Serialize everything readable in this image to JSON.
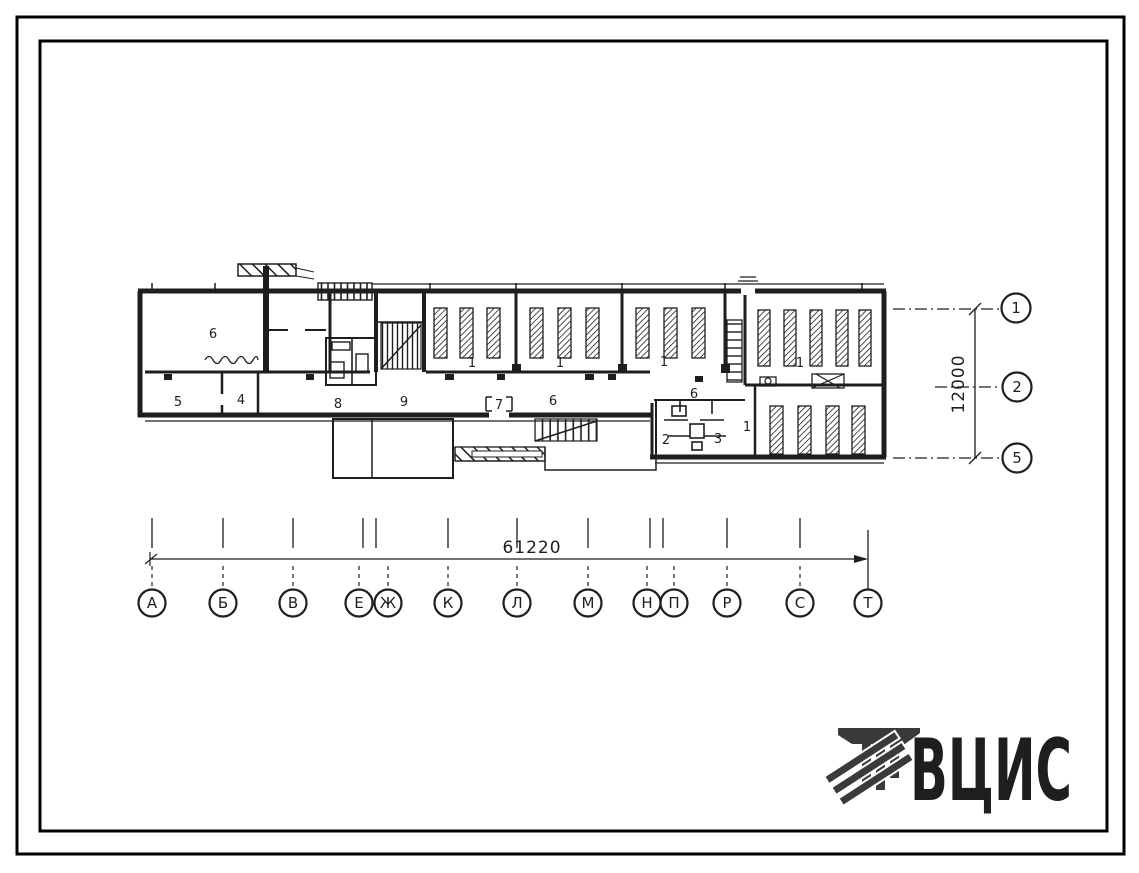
{
  "page": {
    "background": "#ffffff",
    "frame_color": "#000000",
    "ink_color": "#1e1e1e"
  },
  "plan": {
    "room_labels": [
      "6",
      "5",
      "4",
      "8",
      "9",
      "7",
      "6",
      "6",
      "2",
      "3",
      "1",
      "1",
      "1",
      "1",
      "1"
    ]
  },
  "axes": {
    "bottom": {
      "letters": [
        "А",
        "Б",
        "В",
        "Е",
        "Ж",
        "К",
        "Л",
        "М",
        "Н",
        "П",
        "Р",
        "С",
        "Т"
      ]
    },
    "right": {
      "numbers": [
        "1",
        "2",
        "5"
      ]
    }
  },
  "dimensions": {
    "horizontal": "61220",
    "vertical": "12000"
  },
  "logo": {
    "text": "ВЦИС",
    "color": "#3a3a3c"
  }
}
